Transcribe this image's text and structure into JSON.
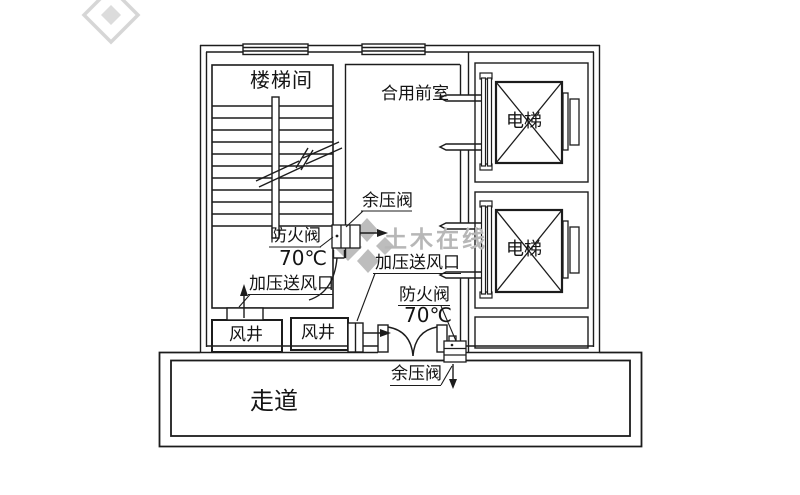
{
  "plan": {
    "rooms": {
      "stairwell": "楼梯间",
      "front_room": "合用前室",
      "elevator": "电梯",
      "air_shaft": "风井",
      "corridor": "走道"
    },
    "annotations": {
      "relief_valve": "余压阀",
      "fire_damper": "防火阀",
      "fire_damper_temp": "70℃",
      "pressure_air_outlet": "加压送风口"
    },
    "watermark": {
      "text": "土木在线"
    },
    "colors": {
      "line": "#1c1c1c",
      "watermark": "#b7b7b7",
      "background": "#ffffff"
    }
  }
}
